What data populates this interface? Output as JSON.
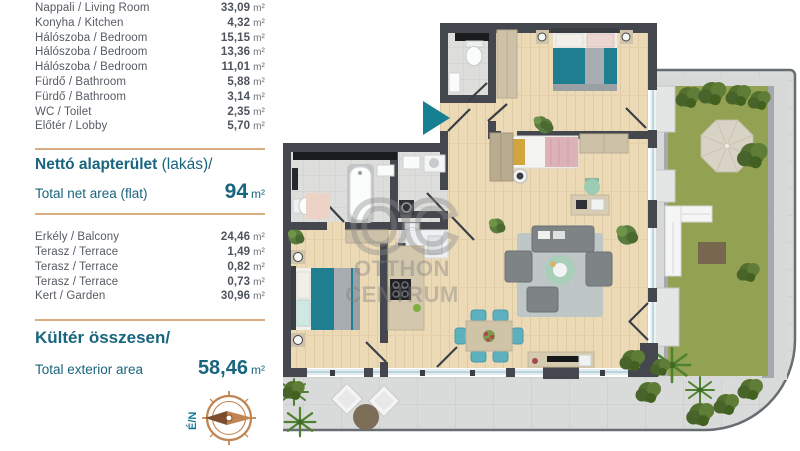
{
  "colors": {
    "accent_teal": "#19647e",
    "divider_tan": "#d9ae80",
    "text_gray": "#555b63",
    "entrance_arrow": "#177f92",
    "wall_dark": "#44484e",
    "wood_floor": "#ecdab6",
    "grass_green": "#93a150",
    "bed_teal": "#1f7e90"
  },
  "panel": {
    "interior_rooms": [
      {
        "label": "Nappali / Living Room",
        "value": "33,09",
        "unit": "m²"
      },
      {
        "label": "Konyha / Kitchen",
        "value": "4,32",
        "unit": "m²"
      },
      {
        "label": "Hálószoba / Bedroom",
        "value": "15,15",
        "unit": "m²"
      },
      {
        "label": "Hálószoba / Bedroom",
        "value": "13,36",
        "unit": "m²"
      },
      {
        "label": "Hálószoba / Bedroom",
        "value": "11,01",
        "unit": "m²"
      },
      {
        "label": "Fürdő / Bathroom",
        "value": "5,88",
        "unit": "m²"
      },
      {
        "label": "Fürdő / Bathroom",
        "value": "3,14",
        "unit": "m²"
      },
      {
        "label": "WC / Toilet",
        "value": "2,35",
        "unit": "m²"
      },
      {
        "label": "Előtér / Lobby",
        "value": "5,70",
        "unit": "m²"
      }
    ],
    "net_area": {
      "title_hu": "Nettó alapterület",
      "title_hu_suffix": " (lakás)/",
      "title_en": "Total net area (flat)",
      "value": "94",
      "unit": "m²"
    },
    "exterior_rooms": [
      {
        "label": "Erkély / Balcony",
        "value": "24,46",
        "unit": "m²"
      },
      {
        "label": "Terasz / Terrace",
        "value": "1,49",
        "unit": "m²"
      },
      {
        "label": "Terasz / Terrace",
        "value": "0,82",
        "unit": "m²"
      },
      {
        "label": "Terasz / Terrace",
        "value": "0,73",
        "unit": "m²"
      },
      {
        "label": "Kert / Garden",
        "value": "30,96",
        "unit": "m²"
      }
    ],
    "exterior_total": {
      "title_hu": "Kültér összesen/",
      "title_en": "Total exterior area",
      "value": "58,46",
      "unit": "m²"
    },
    "compass": {
      "label": "É/N"
    }
  },
  "floorplan": {
    "watermark": {
      "monogram": "OC",
      "line1": "OTTHON",
      "line2": "CENTRUM"
    }
  }
}
